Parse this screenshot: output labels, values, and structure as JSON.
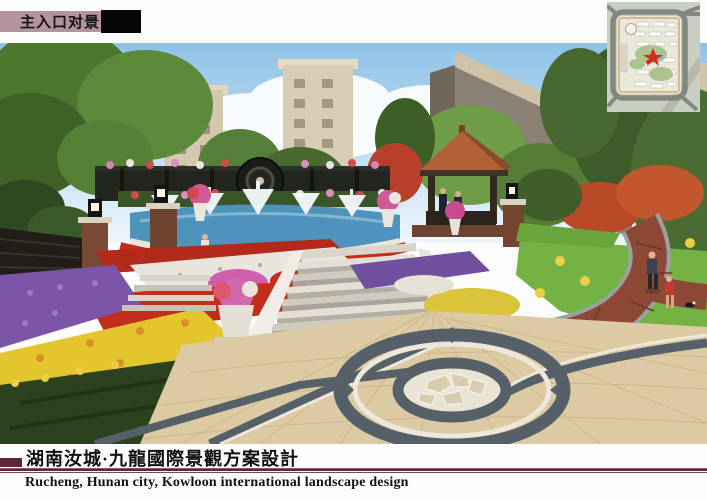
{
  "header": {
    "label": "主入口对景"
  },
  "inset_map": {
    "icon": "site-plan-key-map"
  },
  "footer": {
    "title_zh": "湖南汝城·九龍國際景觀方案設計",
    "title_en": "Rucheng, Hunan city, Kowloon international landscape design"
  },
  "colors": {
    "header_label_bg": "#b2939e",
    "rule_maroon": "#5f2735",
    "sky": "#a6cde9",
    "water": "#4f92bb",
    "lawn": "#74b243",
    "paving_tan": "#dccaa2",
    "granite_dark": "#566068",
    "brick_path": "#8d4936",
    "gazebo_roof": "#b26038",
    "flower_red": "#c22d1c",
    "flower_purple": "#7a55a8",
    "flower_yellow": "#e3c52e",
    "flower_white": "#e7e5de",
    "flower_pink": "#cf5fae",
    "marker_red": "#d42b1f"
  }
}
